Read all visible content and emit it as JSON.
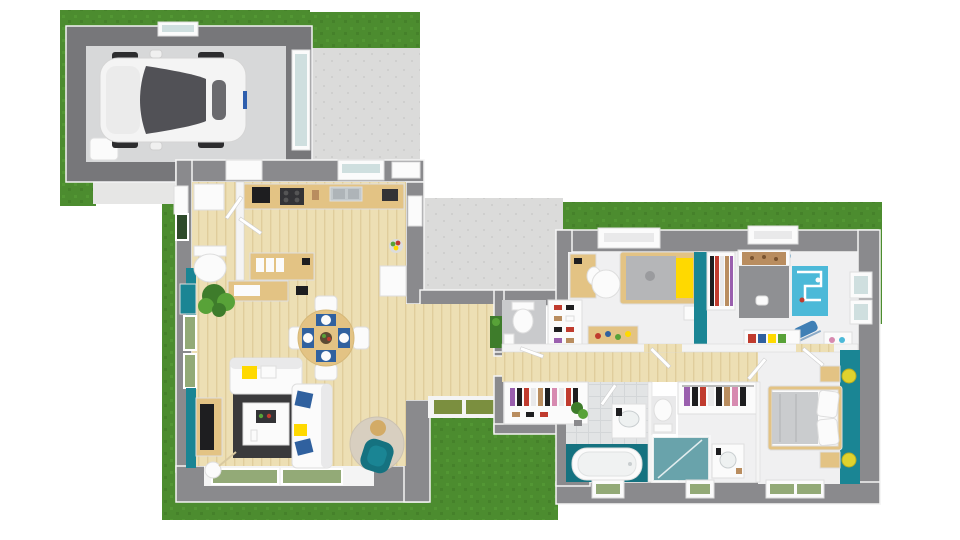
{
  "scene": {
    "kind": "3d-floor-plan-top-view-render",
    "house": {
      "rooms": [
        "garage",
        "driveway",
        "entry-hall",
        "wc-entry",
        "kitchen",
        "office-nook",
        "dining-area",
        "living-room",
        "hallway",
        "terrace",
        "wc-hall",
        "shoe-closet",
        "kid-bedroom-1",
        "kid-bedroom-2",
        "hall-closet",
        "bathroom",
        "shower-room",
        "master-bathroom",
        "walk-in-closet",
        "master-bedroom",
        "garden-lawn"
      ],
      "furniture": [
        "white-car",
        "water-heater",
        "kitchen-counter",
        "coffee-machine",
        "cooktop",
        "kitchen-sink",
        "white-cabinet",
        "fruit-bowl",
        "office-desk",
        "binders",
        "laptop",
        "potted-plant",
        "teal-sideboard",
        "round-dining-table",
        "dining-chairs-x4",
        "blue-placemats-x4",
        "two-seat-sofa",
        "three-seat-sofa",
        "yellow-cushions",
        "blue-cushions",
        "dark-rug",
        "white-coffee-table",
        "tv-console",
        "flat-tv",
        "floor-lamp",
        "round-beige-rug",
        "teal-armchair",
        "side-stool",
        "toilet-x3",
        "shoe-shelf",
        "kid-desk",
        "kid-bed-gray-yellow",
        "white-round-rug",
        "toy-box",
        "nightstand",
        "wardrobe-clothes",
        "kid-bed-gray-print",
        "play-mat-roads",
        "rocking-toy",
        "toy-shelf",
        "clothes-rail",
        "bathtub",
        "vanity-sink-x2",
        "glass-shower",
        "double-bed-white",
        "nightstands-x2",
        "yellow-ball-lamps-x2",
        "door-mats-olive-x2",
        "green-front-door",
        "open-door-leafs"
      ]
    }
  },
  "colors": {
    "bg": "#ffffff",
    "grass": "#4c8c2f",
    "grass_light": "#569c36",
    "grass_dark": "#417c28",
    "wall": "#8a8a8d",
    "wall_dark": "#77777a",
    "wall_white": "#f4f4f4",
    "concrete": "#dbdbda",
    "concrete_dark": "#cfcfce",
    "garage_floor": "#d7d8d9",
    "wood_floor": "#eddfb4",
    "wood_line": "#e0cd9c",
    "wood_furniture": "#e3c384",
    "wood_dark": "#d3ab66",
    "teal": "#1a8594",
    "teal_deep": "#157280",
    "room_floor": "#f0f0f1",
    "tile": "#e2e4e5",
    "tile_line": "#d3d6d8",
    "rug_dark": "#3a3a3c",
    "rug_beige": "#d8cfc0",
    "white": "#fbfbfb",
    "off_white": "#e9e9ea",
    "glass_green": "#93aa77",
    "glass_blue": "#cfdfdf",
    "black": "#1e1e20",
    "appliance_dark": "#333336",
    "steel": "#c3c9cc",
    "yellow": "#ffd900",
    "lamp_yellow": "#dfd32e",
    "blue": "#30619f",
    "play_blue": "#4cb9d8",
    "plant_green": "#3e7c2b",
    "plant_light": "#58a238",
    "olive": "#7b8f3f",
    "duvet_gray": "#b5b6b8",
    "duvet_dark": "#8f9093",
    "brown": "#b98d5f",
    "red": "#c03b2e",
    "purple": "#9a5fae",
    "pink": "#d78ab0",
    "front_door": "#2e4a2a",
    "car_glass": "#515156"
  }
}
